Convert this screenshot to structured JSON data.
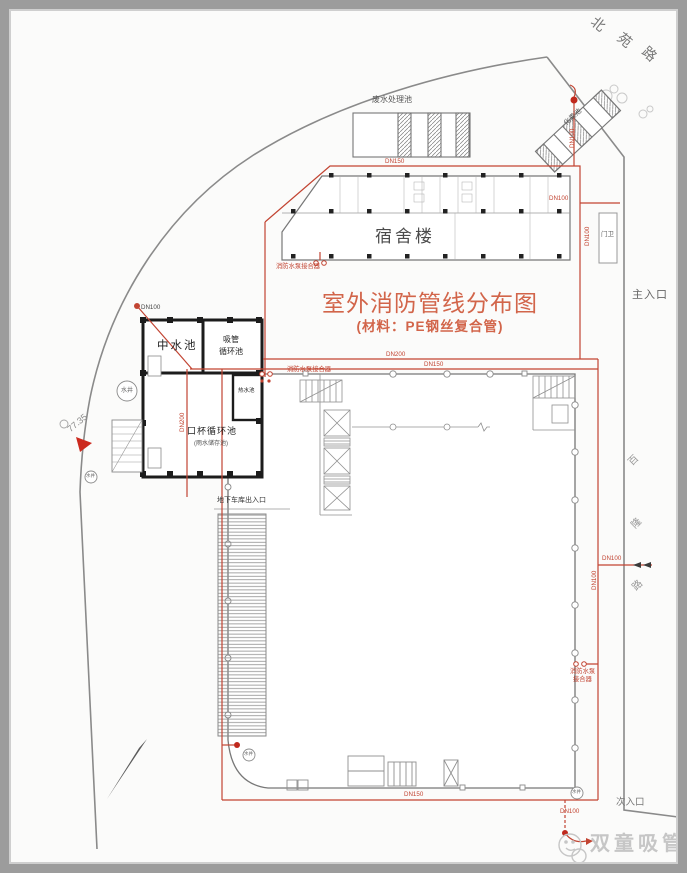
{
  "title": {
    "main": "室外消防管线分布图",
    "subtitle": "(材料：PE钢丝复合管)"
  },
  "roads": {
    "top": {
      "name": "北苑路",
      "chars": [
        "北",
        "苑",
        "路"
      ]
    },
    "right": {
      "name": "百隆路",
      "chars": [
        "百",
        "隆",
        "路"
      ]
    }
  },
  "entrances": {
    "main": "主入口",
    "secondary": "次入口"
  },
  "buildings": {
    "dormitory": "宿舍楼",
    "guard_post": "门卫",
    "wastewater_pool": "废水处理池",
    "septic_tank": "化粪池",
    "garage_entrance": "地下车库出入口"
  },
  "pools": {
    "reclaimed_water": "中水池",
    "straw_circulation": [
      "吸管",
      "循环池"
    ],
    "cup_circulation": "口杯循环池",
    "cup_circulation_sub": "(雨水储存池)",
    "hot_water": "热水池"
  },
  "annotations": {
    "fire_pump_connector": "消防水泵接合器",
    "fire_pump_connector_lines": [
      "消防水泵",
      "接合器"
    ],
    "water_well": "水井",
    "elevation": "77.35"
  },
  "pipes": {
    "dn100": "DN100",
    "dn150": "DN150",
    "dn200": "DN200"
  },
  "watermark": {
    "brand": "双童吸管"
  },
  "colors": {
    "pipe_red": "#c24432",
    "title_orange": "#d2654a",
    "wall_black": "#1c1c1c",
    "line_gray": "#8a8a8a",
    "watermark_gray": "#c6c6c6"
  }
}
